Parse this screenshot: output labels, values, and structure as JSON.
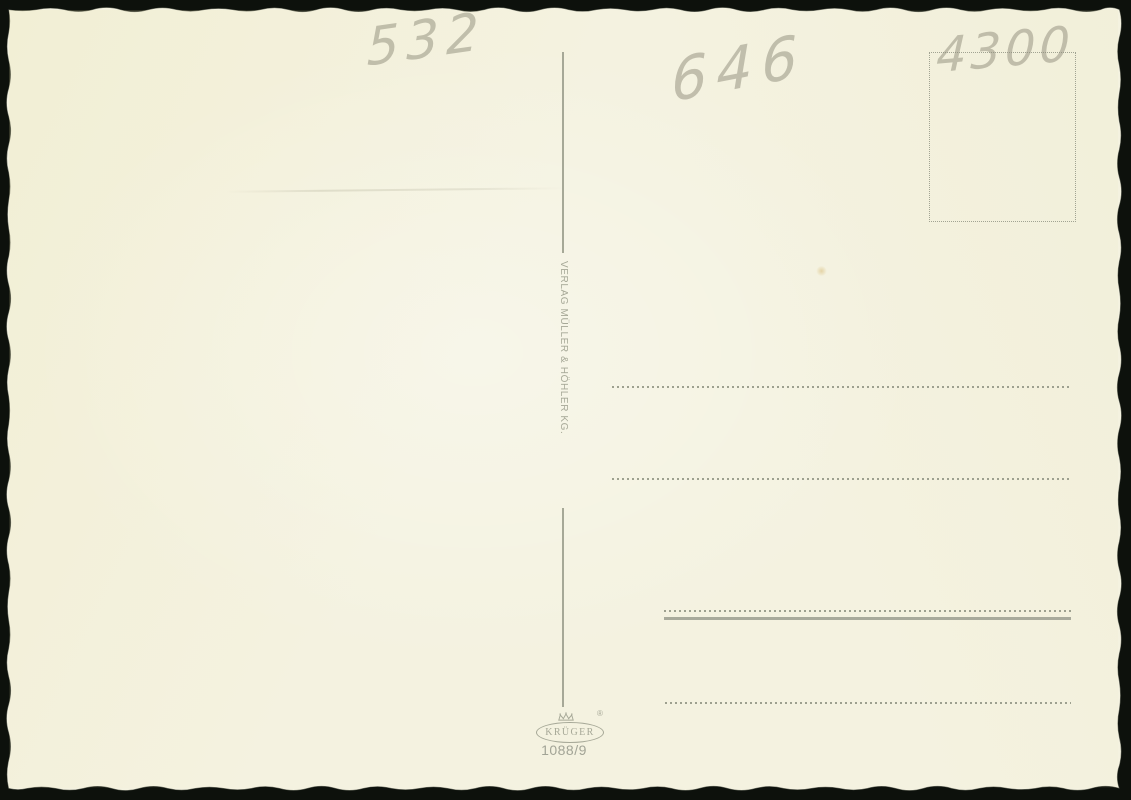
{
  "postcard": {
    "publisher_imprint": "VERLAG MÜLLER & HÖHLER KG.",
    "pencil_notes": {
      "top_left": "532",
      "top_center": "646",
      "stamp_corner": "4300"
    },
    "logo": {
      "brand": "KRÜGER",
      "registered_mark": "®",
      "series_number": "1088/9"
    },
    "colors": {
      "paper": "#f4f2e0",
      "printed_elements": "#a2a496",
      "pencil": "#8f8c7a",
      "surround": "#0d110c"
    }
  }
}
